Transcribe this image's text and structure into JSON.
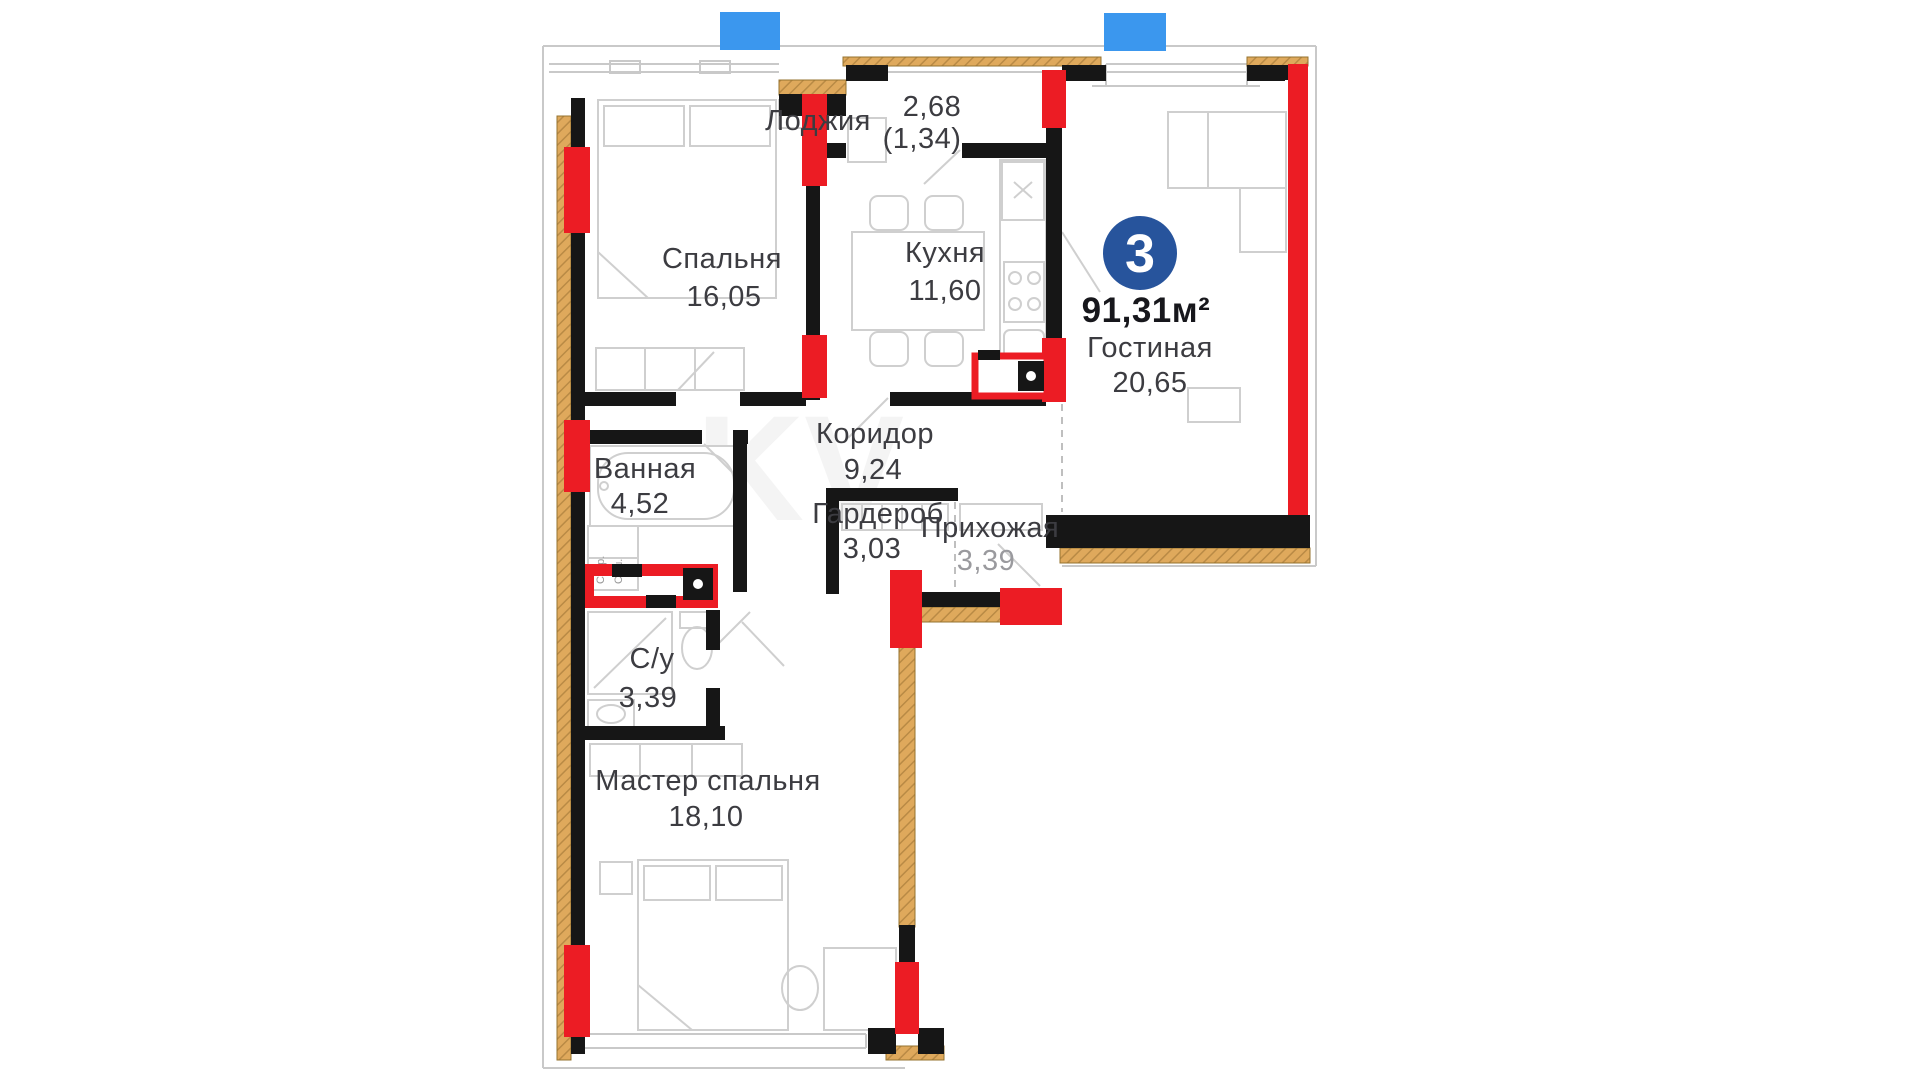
{
  "plan": {
    "type_badge": "3",
    "total_area": "91,31м²",
    "rooms": [
      {
        "name": "Спальня",
        "area": "16,05",
        "label_x": 722,
        "label_y": 268,
        "area_x": 724,
        "area_y": 306
      },
      {
        "name": "Кухня",
        "area": "11,60",
        "label_x": 945,
        "label_y": 262,
        "area_x": 945,
        "area_y": 300
      },
      {
        "name": "Гостиная",
        "area": "20,65",
        "label_x": 1150,
        "label_y": 357,
        "area_x": 1150,
        "area_y": 392
      },
      {
        "name": "Коридор",
        "area": "9,24",
        "label_x": 875,
        "label_y": 443,
        "area_x": 873,
        "area_y": 479
      },
      {
        "name": "Ванная",
        "area": "4,52",
        "label_x": 645,
        "label_y": 478,
        "area_x": 640,
        "area_y": 513
      },
      {
        "name": "Гардероб",
        "area": "3,03",
        "label_x": 878,
        "label_y": 523,
        "area_x": 872,
        "area_y": 558
      },
      {
        "name": "Прихожая",
        "area": "3,39",
        "label_x": 990,
        "label_y": 537,
        "area_x": 986,
        "area_y": 570,
        "muted": true
      },
      {
        "name": "С/у",
        "area": "3,39",
        "label_x": 652,
        "label_y": 668,
        "area_x": 648,
        "area_y": 707
      },
      {
        "name": "Мастер спальня",
        "area": "18,10",
        "label_x": 708,
        "label_y": 790,
        "area_x": 706,
        "area_y": 826
      }
    ],
    "loggia": {
      "name": "Лоджия",
      "area": "2,68",
      "area_half": "(1,34)"
    },
    "appliance_labels": {
      "washer": "Стир.",
      "dryer": "Суш."
    }
  },
  "colors": {
    "wall": "#161616",
    "pier": "#ec1c24",
    "insulation": "#dfa95c",
    "insulation_hatch": "#b98a45",
    "window_marker": "#3b97ee",
    "badge": "#27549c",
    "furniture": "#cfcfcf",
    "outline": "#c9c9c9",
    "label": "#3c3c41",
    "muted": "#9a9a9e"
  }
}
